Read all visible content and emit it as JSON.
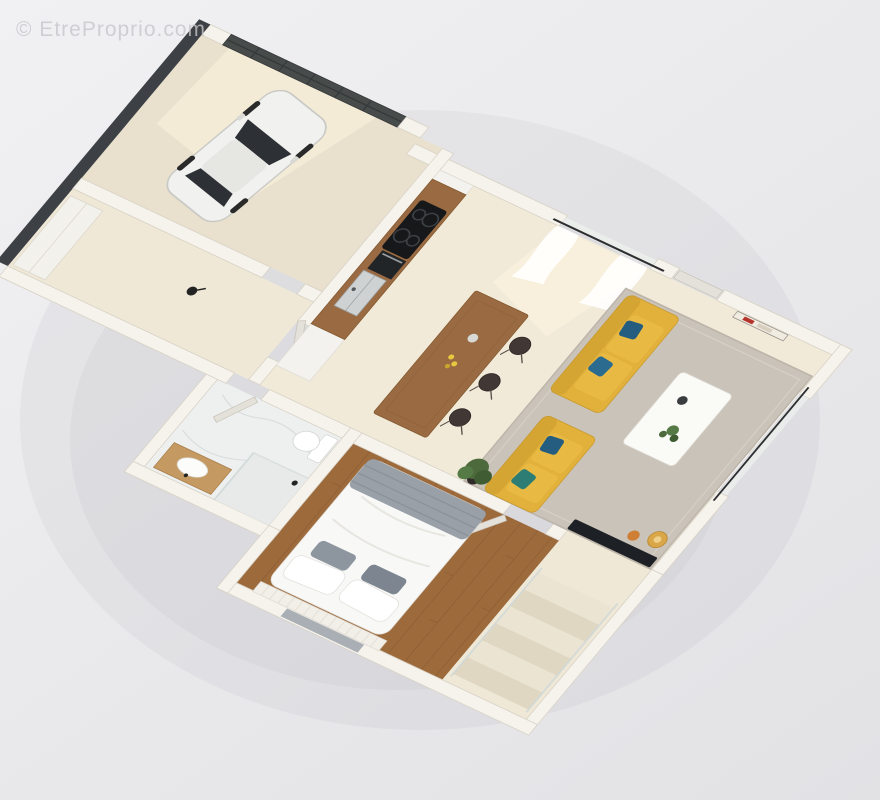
{
  "watermark": {
    "text": "© EtreProprio.com"
  },
  "scene": {
    "type": "3d-floor-plan-render",
    "view": "axonometric top-down, rotated",
    "rooms": [
      {
        "name": "garage",
        "items": [
          "white-car",
          "dark-paneled-garage-door"
        ]
      },
      {
        "name": "hallway",
        "items": [
          "wardrobe",
          "black-table-lamp"
        ]
      },
      {
        "name": "kitchen",
        "items": [
          "wood-counter",
          "sink",
          "cooktop",
          "oven",
          "wood-island",
          "bar-stools",
          "yellow-flowers"
        ]
      },
      {
        "name": "dining-living",
        "items": [
          "gray-rug",
          "yellow-sofa",
          "yellow-sofa",
          "blue-pillows",
          "white-coffee-table",
          "tv",
          "gold-floor-lamp",
          "orange-side-table",
          "potted-plant",
          "wall-art",
          "sheer-curtains",
          "curtain-rods",
          "entry-door"
        ]
      },
      {
        "name": "bathroom",
        "items": [
          "toilet",
          "shower-glass",
          "wood-vanity",
          "white-basin",
          "marble-floor"
        ]
      },
      {
        "name": "bedroom",
        "items": [
          "double-bed",
          "white-duvet",
          "gray-throw",
          "pillows",
          "slat-headboard",
          "parquet-floor",
          "window-slab"
        ]
      },
      {
        "name": "stairs",
        "items": [
          "steps",
          "glass-railing"
        ]
      }
    ],
    "colors": {
      "bg1": "#f1f1f3",
      "bg2": "#e2e2e5",
      "wall": "#f6f3ed",
      "wall_edge": "#d8d2c6",
      "wall_dark": "#3d4044",
      "garage_door": "#474b4a",
      "garage_door_line": "#35383a",
      "floor": "#f1ead9",
      "floor_garage": "#e9e1cd",
      "floor_hall": "#efe8d6",
      "floor_bed": "#9d6a3c",
      "plank": "#8a5a30",
      "wood": "#9a6b42",
      "wood_light": "#c59a62",
      "rug": "#cac3b9",
      "rug_edge": "#bdb5aa",
      "sofa": "#e2b13b",
      "sofa_dark": "#c99a2e",
      "sofa_light": "#e8ba44",
      "pillow_blue": "#245d80",
      "pillow_teal": "#2e7d74",
      "marble": "#eef0ef",
      "vein": "#d7dcde",
      "stool": "#413734",
      "tv": "#1d2024",
      "gold": "#d9a648",
      "orange": "#cf7f35",
      "green1": "#4c6a3c",
      "green2": "#3f5c32",
      "green3": "#567a45",
      "car": "#f1f1ef",
      "car_glass": "#2d3136",
      "steel": "#cfd2d2",
      "white_f": "#fafaf7",
      "gray_blanket": "#99a0a8",
      "gray_pillow": "#8d959e",
      "door_leaf": "#e4e1db",
      "window_glass": "#ecefec",
      "slab": "#a9afb4",
      "sun": "#fff6e2",
      "black": "#232323",
      "glass_rail": "#cfd8d8",
      "watermark": "#c7c7cc"
    }
  }
}
